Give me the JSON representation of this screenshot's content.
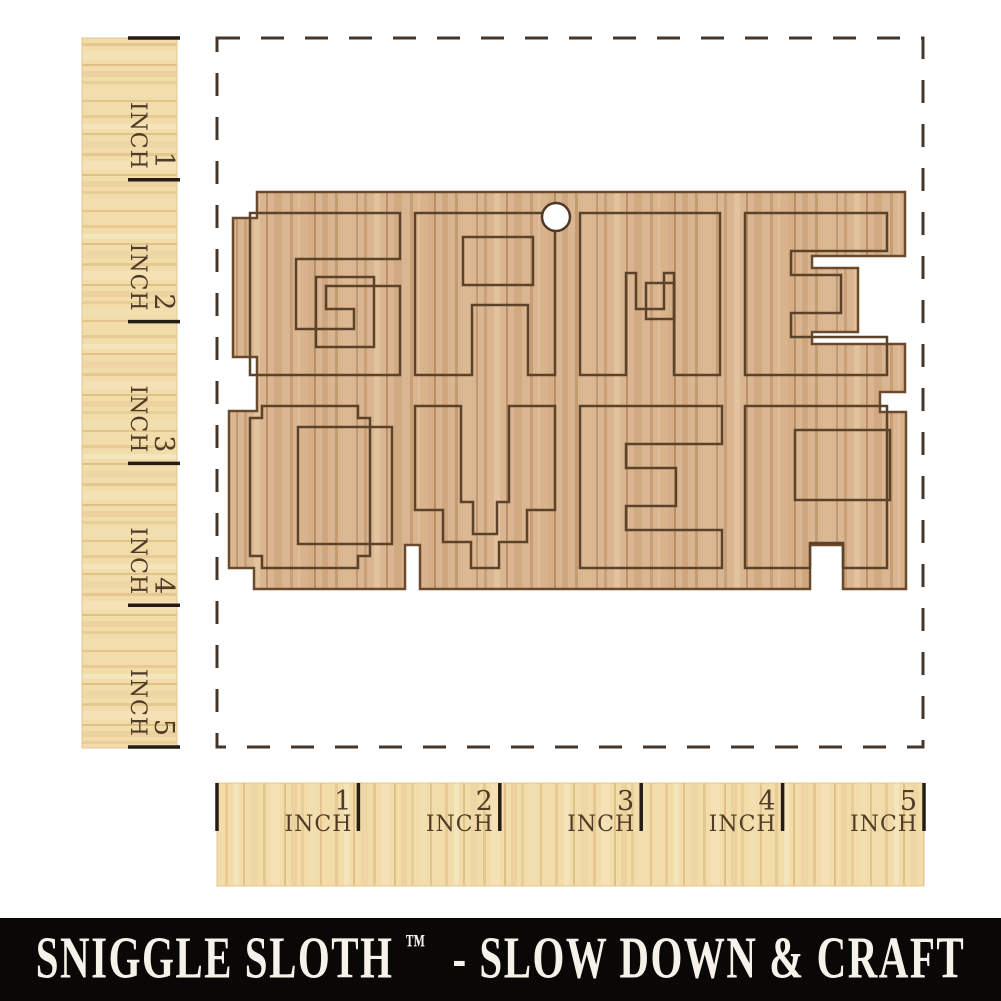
{
  "page": {
    "background": "#ffffff"
  },
  "rulers": {
    "unit_label": "INCH",
    "left": {
      "numbers": [
        "1",
        "2",
        "3",
        "4",
        "5"
      ]
    },
    "bottom": {
      "numbers": [
        "1",
        "2",
        "3",
        "4",
        "5"
      ]
    }
  },
  "measurement_area": {
    "border_color": "#453629",
    "dash": "23 21"
  },
  "plaque": {
    "word": "GAME OVER",
    "material": "wood",
    "colors": {
      "wood_base": "#d9b691",
      "edge": "#6b4a2c",
      "engrave": "#5d422a"
    },
    "silhouette": "M233,218 L257,218 L257,192 L905,192 L905,256 L812,256 L812,268 L858,268 L858,332 L812,332 L812,344 L905,344 L905,392 L880,392 L880,412 L906,412 L906,589 L843,589 L843,545 L810,545 L810,589 L420,589 L420,545 L405,545 L405,589 L254,589 L254,568 L229,568 L229,411 L257,411 L257,357 L233,357 Z",
    "hole": {
      "cx": 556,
      "cy": 217,
      "r": 14
    },
    "letters": [
      {
        "char": "G",
        "x": 250,
        "y": 213,
        "d": "M0,0 H150 V46 H46 V116 H104 V96 H76 V73 H150 V162 H0 Z",
        "echo": {
          "x": 66,
          "y": 64,
          "w": 58,
          "h": 70
        }
      },
      {
        "char": "A",
        "x": 415,
        "y": 213,
        "d": "M0,0 H140 V162 H113 V92 H57 V162 H0 Z",
        "echo": {
          "x": 48,
          "y": 24,
          "w": 70,
          "h": 48
        }
      },
      {
        "char": "M",
        "x": 580,
        "y": 213,
        "d": "M0,0 H140 V162 H94 V60 H84 V96 H56 V60 H46 V162 H0 Z",
        "echo": {
          "x": 66,
          "y": 70,
          "w": 28,
          "h": 36
        }
      },
      {
        "char": "E",
        "x": 745,
        "y": 213,
        "d": "M0,0 H142 V38 H46 V62 H96 V100 H46 V124 H142 V162 H0 Z",
        "echo": null
      },
      {
        "char": "O",
        "x": 250,
        "y": 406,
        "d": "M12,0 L108,0 L108,12 L120,12 L120,150 L108,150 L108,162 L12,162 L12,150 L0,150 L0,12 L12,12 Z",
        "echo": {
          "x": 48,
          "y": 21,
          "w": 94,
          "h": 117
        }
      },
      {
        "char": "V",
        "x": 415,
        "y": 406,
        "d": "M0,0 L46,0 L46,96 L58,96 L58,128 L82,128 L82,96 L94,96 L94,0 L140,0 L140,104 L112,104 L112,136 L84,136 L84,162 L56,162 L56,136 L28,136 L28,104 L0,104 Z",
        "echo": null
      },
      {
        "char": "E",
        "x": 580,
        "y": 406,
        "d": "M0,0 H142 V38 H46 V62 H96 V100 H46 V124 H142 V162 H0 Z",
        "echo": null
      },
      {
        "char": "R",
        "x": 745,
        "y": 406,
        "d": "M0,0 H142 V162 H98 V137 H65 V162 H0 Z",
        "echo": {
          "x": 50,
          "y": 24,
          "w": 95,
          "h": 70
        }
      }
    ]
  },
  "footer": {
    "brand": "SNIGGLE SLOTH",
    "trademark": "™",
    "tagline": "- SLOW DOWN & CRAFT",
    "bg": "#0a0807",
    "fg": "#f6f2e9"
  }
}
